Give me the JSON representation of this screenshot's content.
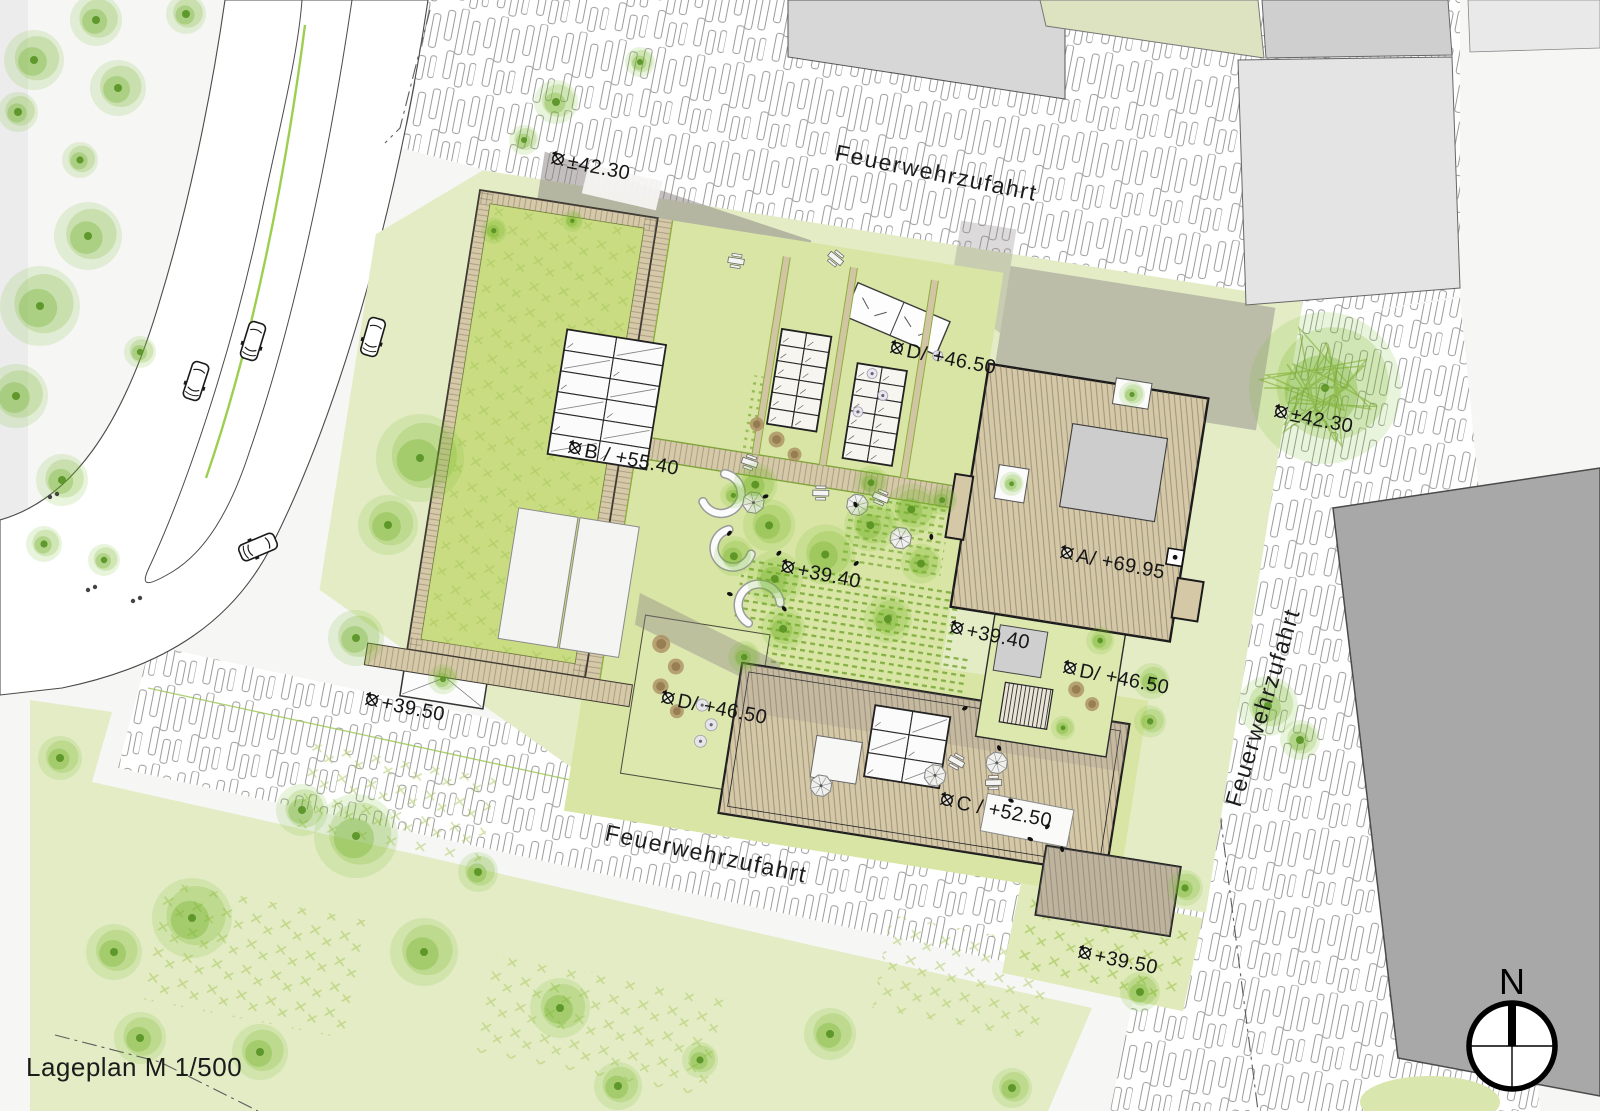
{
  "plan": {
    "title": "Lageplan M 1/500",
    "north_label": "N",
    "street_labels": [
      {
        "location": "north-plaza",
        "text": "Feuerwehrzufahrt"
      },
      {
        "location": "east-side",
        "text": "Feuerwehrzufahrt"
      },
      {
        "location": "south-side",
        "text": "Feuerwehrzufahrt"
      }
    ],
    "level_markers": [
      {
        "location": "north-entry",
        "text": "±42.30"
      },
      {
        "location": "east-lawn",
        "text": "±42.30"
      },
      {
        "location": "roof-b",
        "text": "B / +55.40"
      },
      {
        "location": "roof-a",
        "text": "A/ +69.95"
      },
      {
        "location": "roof-c",
        "text": "C / +52.50"
      },
      {
        "location": "roof-d-north",
        "text": "D/ +46.50"
      },
      {
        "location": "roof-d-east",
        "text": "D/ +46.50"
      },
      {
        "location": "roof-d-west",
        "text": "D/ +46.50"
      },
      {
        "location": "courtyard-west",
        "text": "+39.40"
      },
      {
        "location": "courtyard-east",
        "text": "+39.40"
      },
      {
        "location": "site-southwest",
        "text": "+39.50"
      },
      {
        "location": "site-southeast",
        "text": "+39.50"
      }
    ],
    "colors": {
      "lawn": "#e3ecc5",
      "roof_green": "#c9dc82",
      "courtyard_green": "#d8e5a4",
      "deck_tan": "#d6c9a8",
      "building_light": "#d7d7d7",
      "building_pale_green": "#dde3c0",
      "building_dark": "#a8a8a8",
      "tree_green": "#76b82a",
      "shadow_gray": "#8b8585"
    }
  }
}
